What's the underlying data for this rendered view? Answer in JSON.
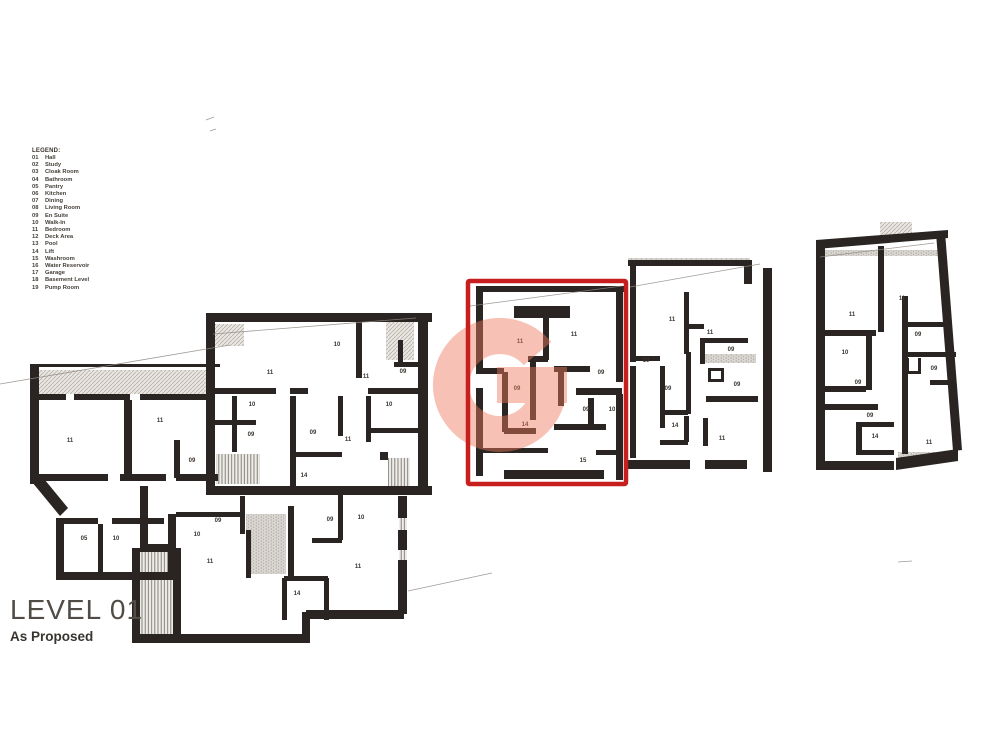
{
  "legend": {
    "title": "LEGEND:",
    "items": [
      {
        "code": "01",
        "label": "Hall"
      },
      {
        "code": "02",
        "label": "Study"
      },
      {
        "code": "03",
        "label": "Cloak Room"
      },
      {
        "code": "04",
        "label": "Bathroom"
      },
      {
        "code": "05",
        "label": "Pantry"
      },
      {
        "code": "06",
        "label": "Kitchen"
      },
      {
        "code": "07",
        "label": "Dining"
      },
      {
        "code": "08",
        "label": "Living Room"
      },
      {
        "code": "09",
        "label": "En Suite"
      },
      {
        "code": "10",
        "label": "Walk-In"
      },
      {
        "code": "11",
        "label": "Bedroom"
      },
      {
        "code": "12",
        "label": "Deck Area"
      },
      {
        "code": "13",
        "label": "Pool"
      },
      {
        "code": "14",
        "label": "Lift"
      },
      {
        "code": "15",
        "label": "Washroom"
      },
      {
        "code": "16",
        "label": "Water Reservoir"
      },
      {
        "code": "17",
        "label": "Garage"
      },
      {
        "code": "18",
        "label": "Basement Level"
      },
      {
        "code": "19",
        "label": "Pump Room"
      }
    ]
  },
  "title_block": {
    "level": "LEVEL 01",
    "status": "As Proposed"
  },
  "watermark": {
    "letter": "G",
    "color": "#ef7a5c",
    "opacity": 0.45
  },
  "highlight": {
    "x": 468,
    "y": 281,
    "w": 158,
    "h": 203,
    "stroke_width": 4.5,
    "color": "#c71f1e"
  },
  "plan": {
    "wall_color": "#2a2522",
    "line_color": "#8f8a83",
    "clusters": [
      {
        "name": "building-left",
        "walls": [
          [
            30,
            364,
            190,
            3
          ],
          [
            30,
            364,
            9,
            120
          ],
          [
            36,
            394,
            30,
            6
          ],
          [
            74,
            394,
            56,
            6
          ],
          [
            140,
            394,
            74,
            6
          ],
          [
            124,
            400,
            8,
            76
          ],
          [
            174,
            440,
            6,
            38
          ],
          [
            36,
            474,
            72,
            7
          ],
          [
            120,
            474,
            46,
            7
          ],
          [
            176,
            474,
            42,
            7
          ],
          [
            56,
            518,
            8,
            58
          ],
          [
            56,
            572,
            120,
            8
          ],
          [
            168,
            514,
            8,
            64
          ],
          [
            62,
            518,
            36,
            6
          ],
          [
            112,
            518,
            52,
            6
          ],
          [
            98,
            524,
            5,
            50
          ],
          [
            206,
            313,
            226,
            9
          ],
          [
            206,
            313,
            9,
            175
          ],
          [
            418,
            316,
            10,
            176
          ],
          [
            206,
            486,
            226,
            9
          ],
          [
            356,
            322,
            6,
            56
          ],
          [
            214,
            388,
            62,
            6
          ],
          [
            290,
            388,
            18,
            6
          ],
          [
            368,
            388,
            54,
            6
          ],
          [
            232,
            396,
            5,
            56
          ],
          [
            214,
            420,
            42,
            5
          ],
          [
            290,
            396,
            6,
            90
          ],
          [
            338,
            396,
            5,
            40
          ],
          [
            290,
            452,
            52,
            5
          ],
          [
            366,
            396,
            5,
            46
          ],
          [
            370,
            428,
            52,
            5
          ],
          [
            394,
            362,
            28,
            5
          ],
          [
            398,
            340,
            5,
            24
          ],
          [
            380,
            452,
            8,
            8
          ],
          [
            140,
            486,
            8,
            64
          ],
          [
            140,
            544,
            36,
            8
          ],
          [
            132,
            548,
            8,
            94
          ],
          [
            173,
            548,
            8,
            94
          ],
          [
            132,
            634,
            170,
            9
          ],
          [
            302,
            612,
            8,
            31
          ],
          [
            306,
            610,
            98,
            9
          ],
          [
            398,
            496,
            9,
            22
          ],
          [
            398,
            530,
            9,
            20
          ],
          [
            398,
            560,
            9,
            54
          ],
          [
            176,
            512,
            66,
            5
          ],
          [
            240,
            496,
            5,
            38
          ],
          [
            246,
            530,
            5,
            48
          ],
          [
            288,
            506,
            6,
            74
          ],
          [
            338,
            492,
            5,
            48
          ],
          [
            312,
            538,
            30,
            5
          ],
          [
            284,
            576,
            44,
            5
          ],
          [
            282,
            578,
            5,
            42
          ],
          [
            324,
            578,
            5,
            42
          ]
        ],
        "polys": [
          "32,482 60,516 68,508 40,474"
        ],
        "hatches": [
          [
            38,
            370,
            176,
            24,
            "d"
          ],
          [
            214,
            324,
            30,
            22,
            "d"
          ],
          [
            386,
            320,
            28,
            40,
            "d"
          ],
          [
            216,
            454,
            44,
            30,
            "v"
          ],
          [
            140,
            548,
            33,
            86,
            "v"
          ],
          [
            246,
            514,
            40,
            60,
            "s"
          ],
          [
            388,
            458,
            22,
            28,
            "v"
          ],
          [
            399,
            518,
            8,
            12,
            "v"
          ],
          [
            399,
            550,
            8,
            10,
            "v"
          ]
        ],
        "rooms": [
          {
            "x": 70,
            "y": 442,
            "t": "11"
          },
          {
            "x": 160,
            "y": 422,
            "t": "11"
          },
          {
            "x": 192,
            "y": 462,
            "t": "09"
          },
          {
            "x": 84,
            "y": 540,
            "t": "05"
          },
          {
            "x": 116,
            "y": 540,
            "t": "10"
          },
          {
            "x": 270,
            "y": 374,
            "t": "11"
          },
          {
            "x": 337,
            "y": 346,
            "t": "10"
          },
          {
            "x": 366,
            "y": 378,
            "t": "11"
          },
          {
            "x": 403,
            "y": 373,
            "t": "09"
          },
          {
            "x": 252,
            "y": 406,
            "t": "10"
          },
          {
            "x": 251,
            "y": 436,
            "t": "09"
          },
          {
            "x": 313,
            "y": 434,
            "t": "09"
          },
          {
            "x": 348,
            "y": 441,
            "t": "11"
          },
          {
            "x": 389,
            "y": 406,
            "t": "10"
          },
          {
            "x": 304,
            "y": 477,
            "t": "14"
          },
          {
            "x": 218,
            "y": 522,
            "t": "09"
          },
          {
            "x": 197,
            "y": 536,
            "t": "10"
          },
          {
            "x": 210,
            "y": 563,
            "t": "11"
          },
          {
            "x": 330,
            "y": 521,
            "t": "09"
          },
          {
            "x": 361,
            "y": 519,
            "t": "10"
          },
          {
            "x": 358,
            "y": 568,
            "t": "11"
          },
          {
            "x": 297,
            "y": 595,
            "t": "14"
          }
        ]
      },
      {
        "name": "unit-highlighted",
        "walls": [
          [
            476,
            286,
            148,
            6
          ],
          [
            476,
            288,
            7,
            86
          ],
          [
            476,
            388,
            7,
            88
          ],
          [
            616,
            288,
            7,
            94
          ],
          [
            616,
            394,
            7,
            86
          ],
          [
            514,
            306,
            56,
            12
          ],
          [
            543,
            316,
            6,
            44
          ],
          [
            528,
            356,
            20,
            6
          ],
          [
            558,
            366,
            6,
            40
          ],
          [
            554,
            366,
            36,
            6
          ],
          [
            576,
            388,
            46,
            7
          ],
          [
            588,
            398,
            6,
            30
          ],
          [
            554,
            424,
            52,
            6
          ],
          [
            502,
            372,
            6,
            60
          ],
          [
            530,
            362,
            6,
            58
          ],
          [
            478,
            368,
            26,
            6
          ],
          [
            504,
            428,
            32,
            6
          ],
          [
            478,
            448,
            70,
            5
          ],
          [
            504,
            470,
            100,
            9
          ],
          [
            596,
            450,
            26,
            5
          ]
        ],
        "polys": [],
        "hatches": [
          [
            478,
            287,
            144,
            5,
            "s"
          ]
        ],
        "rooms": [
          {
            "x": 520,
            "y": 343,
            "t": "11"
          },
          {
            "x": 574,
            "y": 336,
            "t": "11"
          },
          {
            "x": 601,
            "y": 374,
            "t": "09"
          },
          {
            "x": 517,
            "y": 390,
            "t": "09"
          },
          {
            "x": 586,
            "y": 411,
            "t": "09"
          },
          {
            "x": 612,
            "y": 411,
            "t": "10"
          },
          {
            "x": 525,
            "y": 426,
            "t": "14"
          },
          {
            "x": 583,
            "y": 462,
            "t": "15"
          }
        ]
      },
      {
        "name": "unit-middle-right",
        "walls": [
          [
            628,
            260,
            124,
            6
          ],
          [
            630,
            264,
            6,
            98
          ],
          [
            630,
            366,
            6,
            92
          ],
          [
            763,
            268,
            9,
            204
          ],
          [
            744,
            260,
            8,
            24
          ],
          [
            684,
            292,
            5,
            62
          ],
          [
            688,
            324,
            16,
            5
          ],
          [
            700,
            338,
            48,
            5
          ],
          [
            700,
            338,
            5,
            26
          ],
          [
            630,
            356,
            30,
            5
          ],
          [
            660,
            366,
            5,
            62
          ],
          [
            686,
            352,
            5,
            62
          ],
          [
            660,
            410,
            28,
            5
          ],
          [
            684,
            416,
            5,
            26
          ],
          [
            660,
            440,
            28,
            5
          ],
          [
            706,
            396,
            52,
            6
          ],
          [
            703,
            418,
            5,
            28
          ],
          [
            628,
            460,
            62,
            9
          ],
          [
            705,
            460,
            42,
            9
          ],
          [
            708,
            368,
            16,
            3
          ],
          [
            708,
            368,
            3,
            14
          ],
          [
            708,
            379,
            16,
            3
          ],
          [
            721,
            368,
            3,
            14
          ]
        ],
        "polys": [],
        "hatches": [
          [
            700,
            354,
            56,
            9,
            "s"
          ],
          [
            628,
            258,
            122,
            5,
            "s"
          ]
        ],
        "rooms": [
          {
            "x": 672,
            "y": 321,
            "t": "11"
          },
          {
            "x": 710,
            "y": 334,
            "t": "11"
          },
          {
            "x": 731,
            "y": 351,
            "t": "09"
          },
          {
            "x": 646,
            "y": 362,
            "t": "10"
          },
          {
            "x": 668,
            "y": 390,
            "t": "09"
          },
          {
            "x": 737,
            "y": 386,
            "t": "09"
          },
          {
            "x": 675,
            "y": 427,
            "t": "14"
          },
          {
            "x": 722,
            "y": 440,
            "t": "11"
          }
        ]
      },
      {
        "name": "unit-right",
        "walls": [
          [
            816,
            240,
            9,
            226
          ],
          [
            816,
            461,
            78,
            9
          ],
          [
            878,
            246,
            6,
            86
          ],
          [
            822,
            330,
            54,
            6
          ],
          [
            866,
            334,
            6,
            56
          ],
          [
            822,
            386,
            44,
            6
          ],
          [
            822,
            404,
            56,
            6
          ],
          [
            856,
            424,
            6,
            30
          ],
          [
            856,
            422,
            38,
            5
          ],
          [
            856,
            450,
            38,
            5
          ],
          [
            902,
            296,
            6,
            60
          ],
          [
            908,
            322,
            42,
            5
          ],
          [
            902,
            352,
            54,
            5
          ],
          [
            902,
            356,
            6,
            98
          ],
          [
            906,
            358,
            3,
            16
          ],
          [
            918,
            358,
            3,
            16
          ],
          [
            906,
            371,
            15,
            3
          ],
          [
            930,
            380,
            24,
            5
          ]
        ],
        "polys": [
          "816,240 948,230 948,238 816,249",
          "936,233 945,232 962,450 953,451",
          "896,458 958,449 958,461 896,470"
        ],
        "hatches": [
          [
            880,
            222,
            32,
            17,
            "d"
          ],
          [
            898,
            452,
            52,
            10,
            "s"
          ],
          [
            820,
            250,
            118,
            6,
            "s"
          ]
        ],
        "rooms": [
          {
            "x": 852,
            "y": 316,
            "t": "11"
          },
          {
            "x": 902,
            "y": 300,
            "t": "11"
          },
          {
            "x": 918,
            "y": 336,
            "t": "09"
          },
          {
            "x": 845,
            "y": 354,
            "t": "10"
          },
          {
            "x": 858,
            "y": 384,
            "t": "09"
          },
          {
            "x": 934,
            "y": 370,
            "t": "09"
          },
          {
            "x": 870,
            "y": 417,
            "t": "09"
          },
          {
            "x": 875,
            "y": 438,
            "t": "14"
          },
          {
            "x": 929,
            "y": 444,
            "t": "11"
          }
        ]
      }
    ],
    "lines": [
      [
        0,
        384,
        230,
        345
      ],
      [
        213,
        334,
        416,
        318
      ],
      [
        470,
        306,
        622,
        286
      ],
      [
        630,
        287,
        760,
        264
      ],
      [
        820,
        257,
        934,
        243
      ],
      [
        408,
        591,
        492,
        573
      ],
      [
        206,
        120,
        214,
        117
      ],
      [
        210,
        131,
        216,
        129
      ],
      [
        898,
        562,
        912,
        561
      ]
    ]
  }
}
